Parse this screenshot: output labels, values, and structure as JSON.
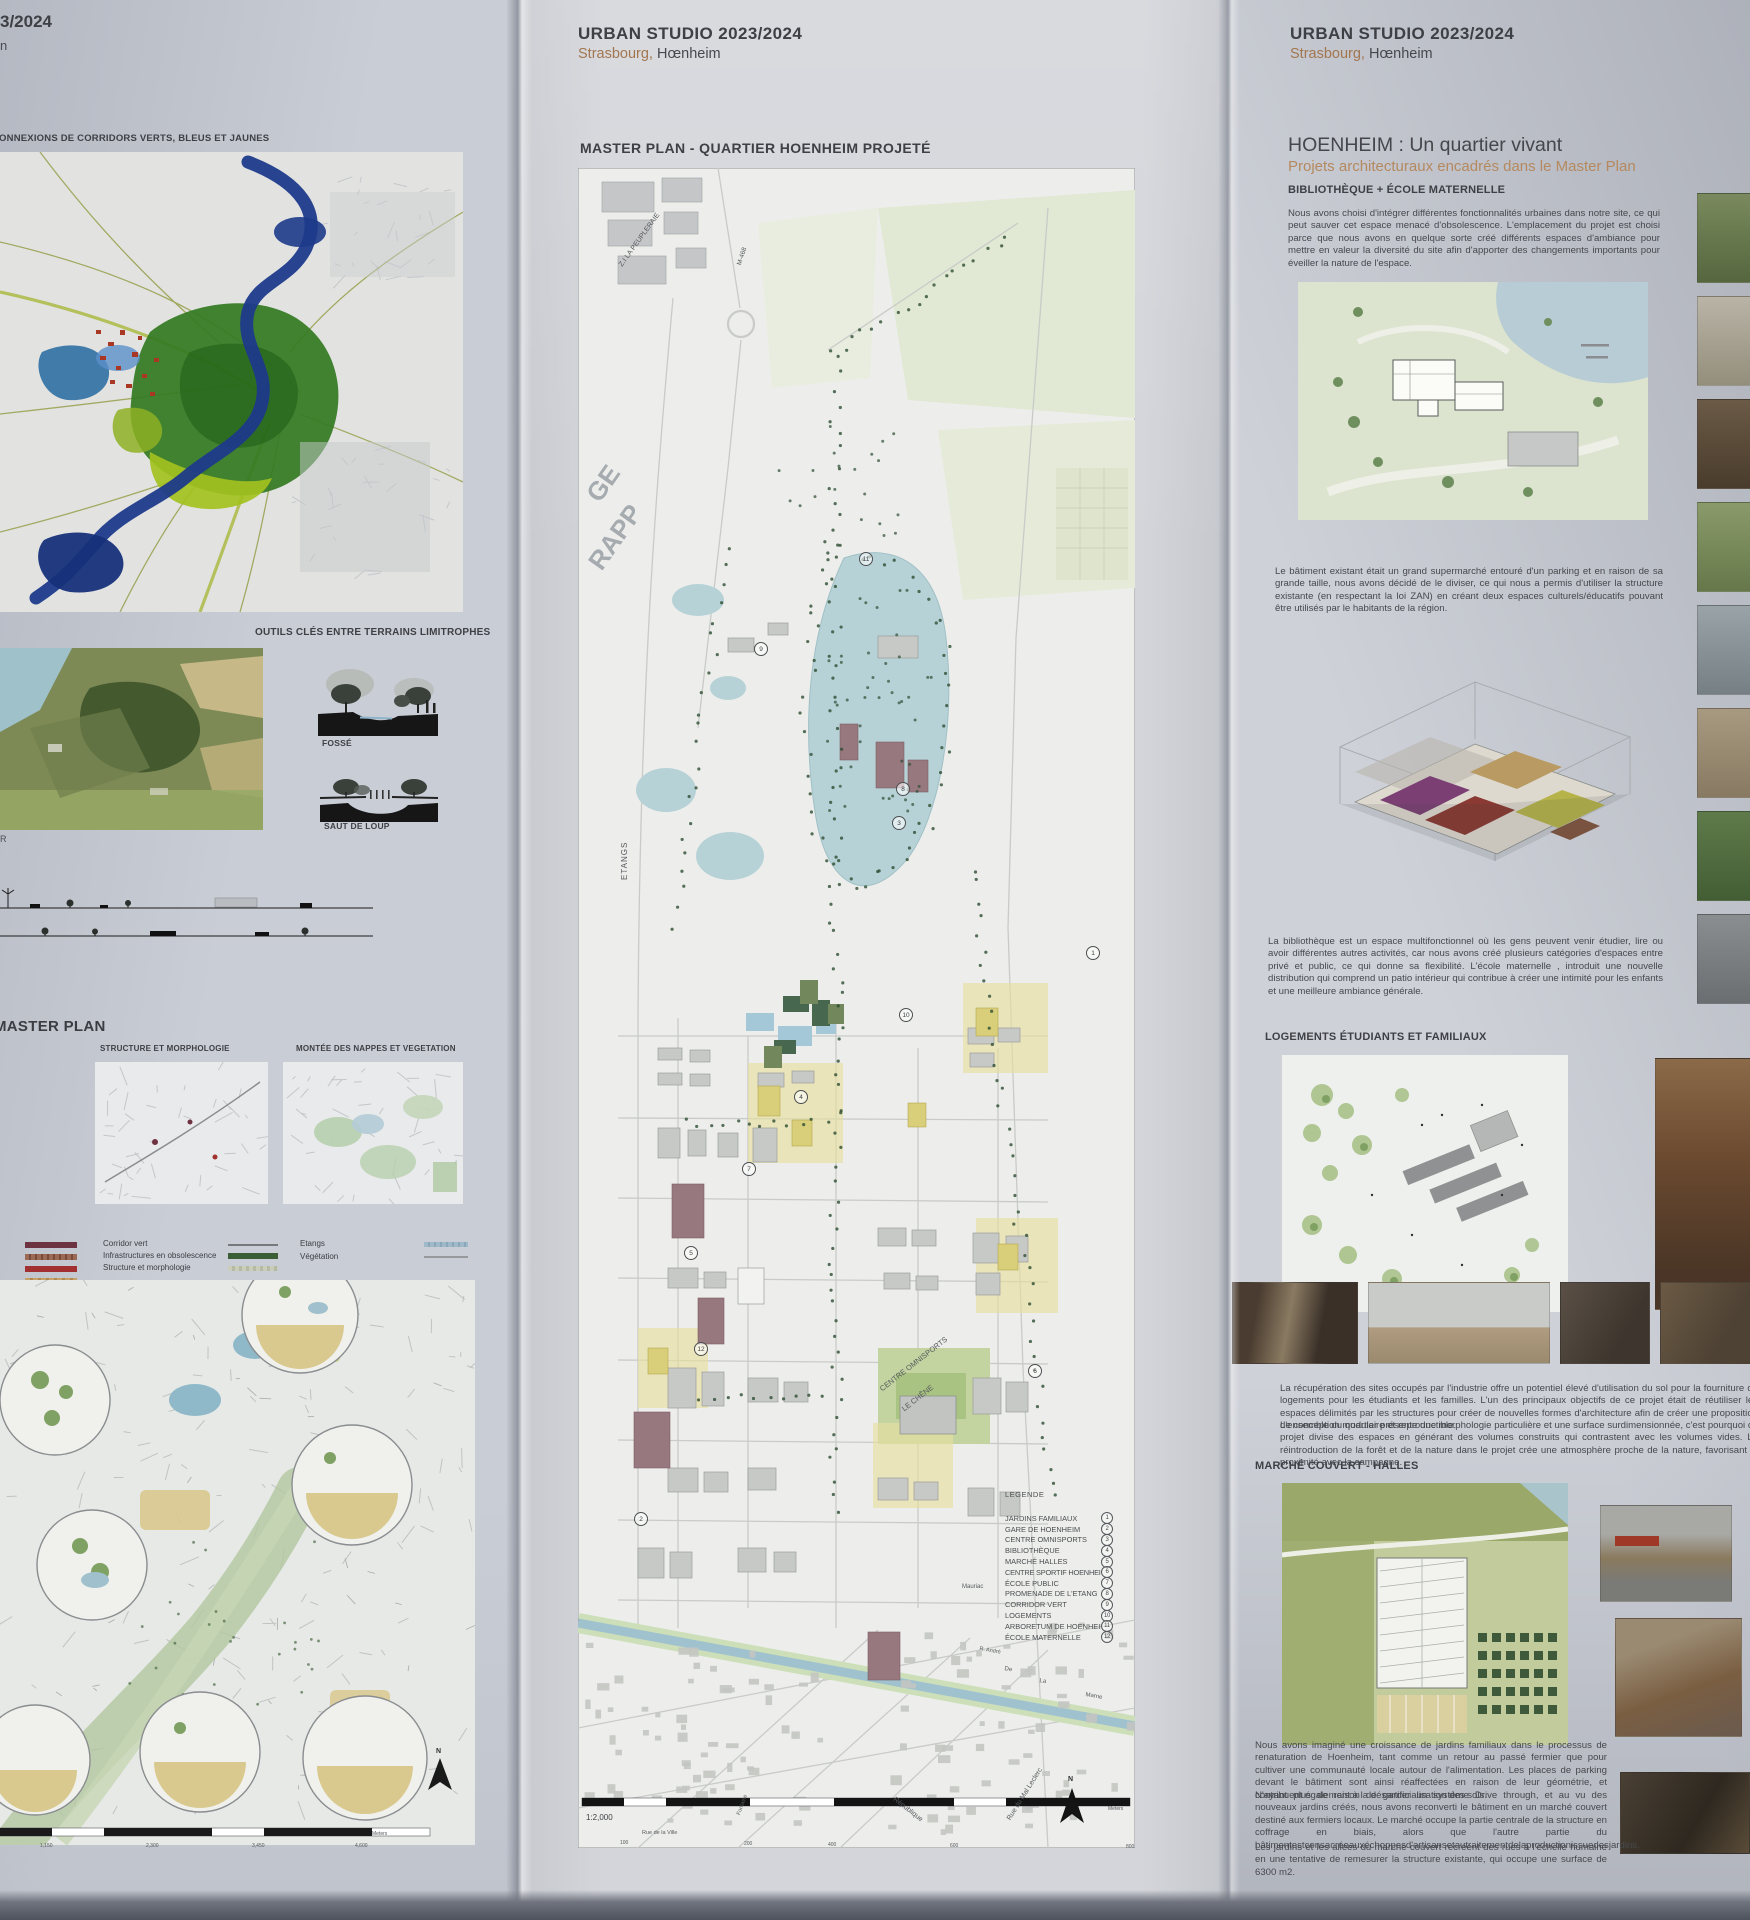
{
  "left_panel": {
    "header_fragment_top": "3/2024",
    "header_fragment_bottom": "n",
    "corridors_title": "CONNEXIONS DE CORRIDORS VERTS, BLEUS ET JAUNES",
    "outils_title": "OUTILS CLÉS ENTRE TERRAINS LIMITROPHES",
    "fosse_label": "FOSSÉ",
    "saut_label": "SAUT DE LOUP",
    "edge_fragment": "R",
    "master_plan_title": "MASTER PLAN",
    "structure_title": "STRUCTURE ET MORPHOLOGIE",
    "nappes_title": "MONTÉE DES NAPPES ET VEGETATION",
    "legend": {
      "corridor_vert": "Corridor vert",
      "infrastructures": "Infrastructures en obsolescence",
      "structure": "Structure et morphologie",
      "etangs": "Etangs",
      "vegetation": "Végétation"
    },
    "scale_ticks": [
      "1,150",
      "2,300",
      "3,450",
      "4,600"
    ],
    "meters_label": "Meters",
    "north_label": "N"
  },
  "center_panel": {
    "studio_line": "URBAN STUDIO 2023/2024",
    "city": "Strasbourg,",
    "place": "Hœnheim",
    "map_title": "MASTER PLAN - QUARTIER HOENHEIM PROJETÉ",
    "map_labels": {
      "zi": "Z.I LA PEUPLERAIE",
      "m468": "M-468",
      "big1": "GE",
      "big2": "RAPP",
      "etangs": "ETANGS",
      "omnisports1": "CENTRE OMNISPORTS",
      "omnisports2": "LE CHÊNE",
      "mauriac": "Mauriac",
      "republique": "République",
      "leclerc": "Rue du Mal Leclerc",
      "rue_ville": "Rue de la Ville",
      "fontaine": "Fontaine",
      "r_andre": "R. André",
      "de": "De",
      "la": "La",
      "marne": "Marne"
    },
    "legend": {
      "title": "LEGENDE",
      "items": [
        {
          "label": "JARDINS FAMILIAUX",
          "num": "1"
        },
        {
          "label": "GARE DE HOENHEIM",
          "num": "2"
        },
        {
          "label": "CENTRE OMNISPORTS",
          "num": "3"
        },
        {
          "label": "BIBLIOTHÈQUE",
          "num": "4"
        },
        {
          "label": "MARCHÉ HALLES",
          "num": "5"
        },
        {
          "label": "CENTRE SPORTIF HOENHEIM",
          "num": "6"
        },
        {
          "label": "ÉCOLE PUBLIC",
          "num": "7"
        },
        {
          "label": "PROMENADE DE L'ETANG",
          "num": "8"
        },
        {
          "label": "CORRIDOR VERT",
          "num": "9"
        },
        {
          "label": "LOGEMENTS",
          "num": "10"
        },
        {
          "label": "ARBORETUM DE HOENHEIM",
          "num": "11"
        },
        {
          "label": "ÉCOLE MATERNELLE",
          "num": "12"
        }
      ]
    },
    "scale_label": "1:2,000",
    "scale_ticks": [
      "100",
      "200",
      "400",
      "600",
      "800"
    ],
    "meters_label": "Meters",
    "north_label": "N"
  },
  "right_panel": {
    "studio_line": "URBAN STUDIO 2023/2024",
    "city": "Strasbourg,",
    "place": "Hœnheim",
    "main_title": "HOENHEIM : Un quartier vivant",
    "subtitle": "Projets architecturaux encadrés dans le Master Plan",
    "section1_title": "BIBLIOTHÈQUE + ÉCOLE MATERNELLE",
    "para1": "Nous avons choisi d'intégrer différentes fonctionnalités urbaines dans notre site, ce qui peut sauver cet espace menacé d'obsolescence. L'emplacement du projet est choisi parce que nous avons en quelque sorte créé différents espaces d'ambiance pour mettre en valeur la diversité du site afin d'apporter des changements importants pour éveiller la nature de l'espace.",
    "para2": "Le bâtiment existant était un grand supermarché entouré d'un parking et en raison de sa grande taille, nous avons décidé de le diviser, ce qui nous a permis d'utiliser la structure existante (en respectant la loi ZAN) en créant deux espaces culturels/éducatifs pouvant être utilisés par le habitants de la région.",
    "para3": "La bibliothèque est un espace multifonctionnel où les gens peuvent venir étudier, lire ou avoir différentes autres activités, car nous avons créé plusieurs catégories d'espaces entre privé et public, ce qui donne sa flexibilité. L'école maternelle , introduit une nouvelle distribution qui comprend un patio intérieur qui contribue à créer une intimité pour les enfants et une meilleure ambiance générale.",
    "section2_title": "LOGEMENTS ÉTUDIANTS ET FAMILIAUX",
    "para4": "La récupération des sites occupés par l'industrie offre un potentiel élevé d'utilisation du sol pour la fourniture de logements pour les étudiants et les familles. L'un des principaux objectifs de ce projet était de réutiliser les espaces délimités par les structures pour créer de nouvelles formes d'architecture afin de créer une proposition de conception modulaire et reproductible.",
    "para5": "L'ensemble du quartier présente une morphologie particulière et une surface surdimensionnée, c'est pourquoi ce projet divise des espaces en générant des volumes construits qui contrastent avec les volumes vides. La réintroduction de la forêt et de la nature dans le projet crée une atmosphère proche de la nature, favorisant la proximité avec la campagne.",
    "section3_title": "MARCHÉ COUVERT - HALLES",
    "para6": "Nous avons imaginé une croissance de jardins familiaux dans le processus de renaturation de Hoenheim, tant comme un retour au passé fermier que pour cultiver une communauté locale autour de l'alimentation. Les places de parking devant le bâtiment sont ainsi réaffectées en raison de leur géométrie, et contribuent également à la désartificialisation des sols.",
    "para7": "N'ayant plus de raison de garder un système Drive through, et au vu des nouveaux jardins créés, nous avons reconverti le bâtiment en un marché couvert destiné aux fermiers locaux. Le marché occupe la partie centrale de la structure en coffrage en biais, alors que l'autre partie du bâtimentestconsacréeauxéchoppesd'artisansetautraitementdelaproductionissuedesjardins.",
    "para8": "Les jardins et les allées du marché couvert recréent des rues à l'échelle humaine en une tentative de remesurer la structure existante, qui occupe une surface de 6300 m2."
  },
  "colors": {
    "accent_brown": "#a3764f",
    "ink": "#3e4045",
    "paper": "#d0d3d9",
    "pond_blue": "#b7d2d6",
    "corridor_green": "#4c6b44"
  }
}
